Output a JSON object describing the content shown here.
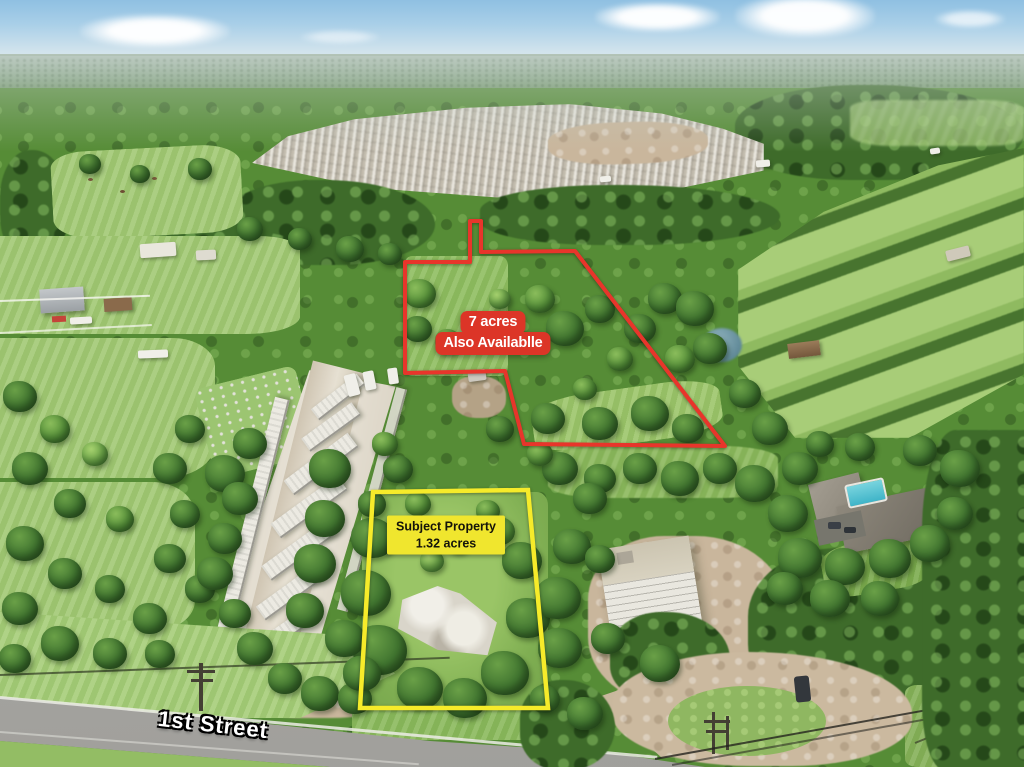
{
  "annotations": {
    "available_parcel": {
      "line1": "7 acres",
      "line2": "Also Availablle",
      "bg_color": "#dc3527",
      "text_color": "#ffffff",
      "outline_color": "#e8352b",
      "outline_points": "405,262 470,262 470,221 481,221 481,252 575,251 725,446 524,444 505,371 405,373"
    },
    "subject_property": {
      "line1": "Subject Property",
      "line2": "1.32 acres",
      "bg_color": "#f0e62e",
      "text_color": "#15140a",
      "outline_color": "#f6eb2a",
      "outline_points": "373,492 528,490 548,708 360,708"
    },
    "street_label": {
      "text": "1st Street",
      "text_color": "#ffffff",
      "outline_color": "#000000"
    }
  },
  "scene": {
    "palette": {
      "sky": "#a9cfe8",
      "horizon_haze": "#b4c4b8",
      "forest_dark": "#3e6b2a",
      "forest_mid": "#568c36",
      "field_light": "#a6cc76",
      "dirt": "#c9b69c",
      "concrete": "#e9e4d8",
      "road": "#a8a7a3",
      "pool": "#62c8d6",
      "label_red": "#dc3527",
      "label_yellow": "#f0e62e"
    }
  }
}
